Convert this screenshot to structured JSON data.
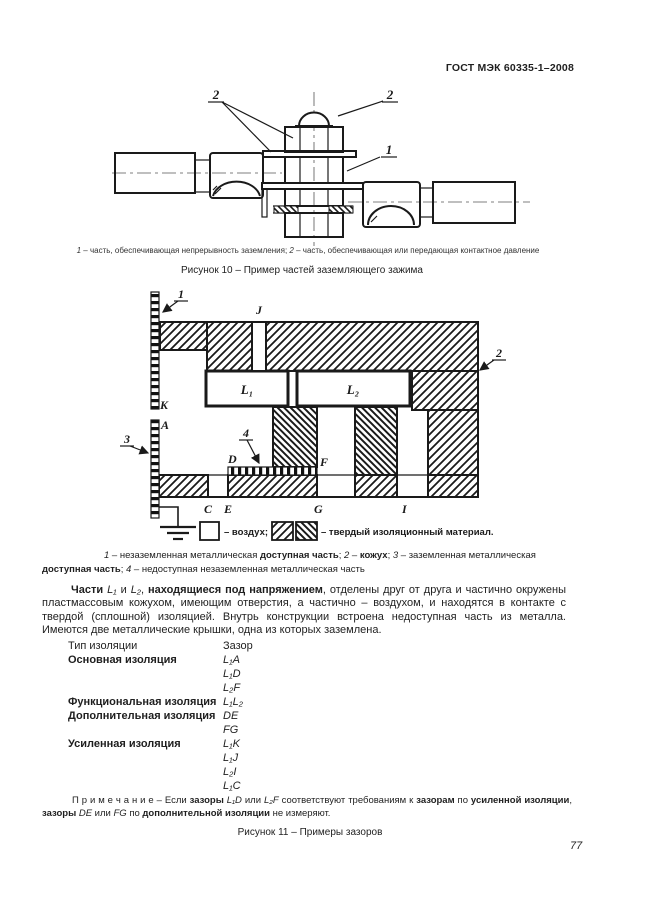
{
  "header": {
    "title": "ГОСТ МЭК 60335-1–2008"
  },
  "figure10": {
    "labels": {
      "part2_left": "2",
      "part2_right": "2",
      "part1": "1"
    },
    "caption_segments": [
      {
        "t": "1",
        "i": true
      },
      {
        "t": " – часть, обеспечивающая непрерывность заземления; "
      },
      {
        "t": "2",
        "i": true
      },
      {
        "t": " – часть, обеспечивающая или передающая контактное давление"
      }
    ],
    "title": "Рисунок 10 – Пример частей заземляющего зажима"
  },
  "figure11": {
    "labels": {
      "n1": "1",
      "n2": "2",
      "n3": "3",
      "n4": "4",
      "j": "J",
      "k": "K",
      "a": "A",
      "d": "D",
      "f": "F",
      "c": "C",
      "e": "E",
      "g": "G",
      "i": "I",
      "l1": "L₁",
      "l2": "L₂"
    },
    "legend": {
      "air": "– воздух;",
      "solid": "– твердый изоляционный материал."
    },
    "caption_segments": [
      {
        "t": "1",
        "i": true
      },
      {
        "t": " – незаземленная металлическая "
      },
      {
        "t": "доступная часть",
        "b": true
      },
      {
        "t": "; "
      },
      {
        "t": "2",
        "i": true
      },
      {
        "t": " – "
      },
      {
        "t": "кожух",
        "b": true
      },
      {
        "t": "; "
      },
      {
        "t": "3",
        "i": true
      },
      {
        "t": " – заземленная металлическая "
      },
      {
        "t": "доступная часть",
        "b": true
      },
      {
        "t": "; "
      },
      {
        "t": "4",
        "i": true
      },
      {
        "t": " – недоступная незаземленная металлическая часть"
      }
    ],
    "title": "Рисунок 11 – Примеры зазоров"
  },
  "paragraph_segments": [
    {
      "t": "Части ",
      "b": true
    },
    {
      "t": "L₁",
      "i": true
    },
    {
      "t": " и "
    },
    {
      "t": "L₂",
      "i": true
    },
    {
      "t": ", "
    },
    {
      "t": "находящиеся под напряжением",
      "b": true
    },
    {
      "t": ", отделены друг от друга и частично окружены пластмассовым кожухом, имеющим отверстия, а частично – воздухом, и находятся в контакте с твердой (сплошной) изоляцией. Внутрь конструкции встроена недоступная часть из металла. Имеются две металлические крышки, одна из которых заземлена."
    }
  ],
  "table": {
    "rows": [
      {
        "label": "Тип изоляции",
        "gaps": [
          "Зазор"
        ]
      },
      {
        "label": "Основная изоляция",
        "gaps": [
          "L₁A",
          "L₁D",
          "L₂F"
        ]
      },
      {
        "label": "Функциональная изоляция",
        "gaps": [
          "L₁L₂"
        ]
      },
      {
        "label": "Дополнительная изоляция",
        "gaps": [
          "DE",
          "FG"
        ]
      },
      {
        "label": "Усиленная изоляция",
        "gaps": [
          "L₁K",
          "L₁J",
          "L₂I",
          "L₁C"
        ]
      }
    ]
  },
  "note_segments": [
    {
      "t": "П р и м е ч а н и е  – Если "
    },
    {
      "t": "зазоры",
      "b": true
    },
    {
      "t": " "
    },
    {
      "t": "L₁D",
      "i": true
    },
    {
      "t": " или "
    },
    {
      "t": "L₂F",
      "i": true
    },
    {
      "t": " соответствуют требованиям к "
    },
    {
      "t": "зазорам",
      "b": true
    },
    {
      "t": " по "
    },
    {
      "t": "усиленной изоляции",
      "b": true
    },
    {
      "t": ", "
    },
    {
      "t": "зазоры",
      "b": true
    },
    {
      "t": " "
    },
    {
      "t": "DE",
      "i": true
    },
    {
      "t": " или "
    },
    {
      "t": "FG",
      "i": true
    },
    {
      "t": " по "
    },
    {
      "t": "дополнительной изоляции",
      "b": true
    },
    {
      "t": " не измеряют."
    }
  ],
  "page_number": "77"
}
